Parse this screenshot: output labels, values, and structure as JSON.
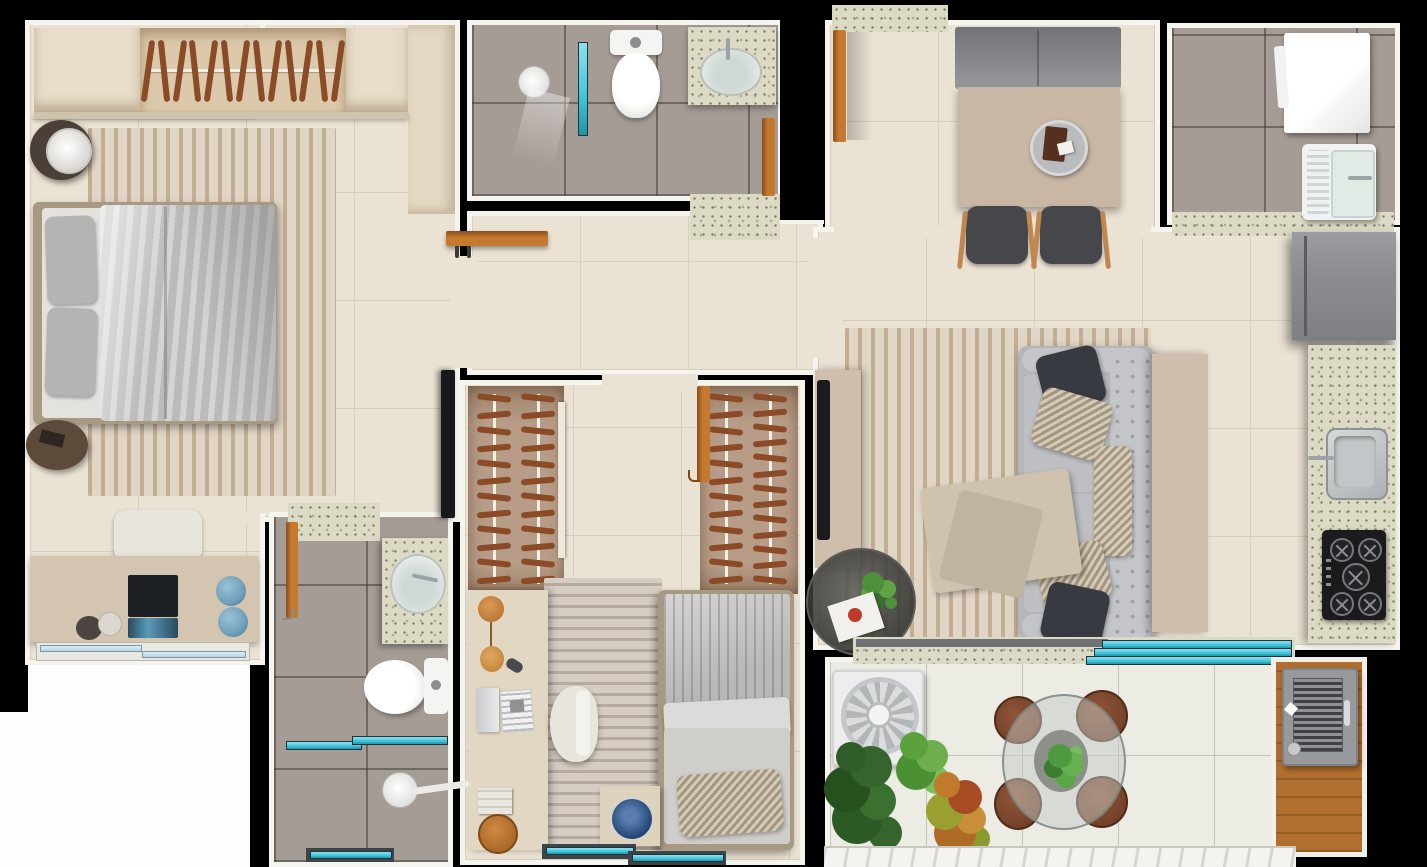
{
  "scene": {
    "description": "Top-down 3D rendered apartment floor plan with two bedrooms, two bathrooms, hallway closets, kitchen, dining, living room, laundry area and balcony with grill",
    "background": "#000000"
  },
  "palette": {
    "bg": "#000000",
    "wallWhite": "#f6f4ef",
    "floorBeige": "#eae2d3",
    "floorLine": "#d7cebc",
    "tileGray": "#a59c96",
    "granite": "#dcd9c4",
    "graniteDot": "#7c7c5e",
    "graniteDot2": "#a9a98c",
    "wood": "#c5792f",
    "woodEdge": "#8a4d1e",
    "hanger": "#8a4b26",
    "closetTan": "#b79d88",
    "glass": "#45c8dc",
    "glassFrame": "#20333c",
    "windowBlue": "#b9d4e4",
    "rugBeige": "#e0d6c7",
    "rugStreak": "#c3ae92",
    "duvet": "#c6c5c3",
    "bedFrame": "#a89a82",
    "pillowGray": "#b5b4b2",
    "sofaGray": "#b4b6b9",
    "sofaLight": "#c3c5c8",
    "pillowDark": "#373b41",
    "benchGray": "#85878b",
    "tableTaupe": "#c9b7a5",
    "consoleBeige": "#cfbeac",
    "chairDark": "#45474b",
    "chairWood": "#c08850",
    "fridgeGray": "#8b8d91",
    "steel": "#c3c6c8",
    "cooktopBlack": "#1b1b1d",
    "grillGray": "#97999d",
    "nicheWood": "#b06f2e",
    "plantGreen": "#4e8f3c",
    "plantDark": "#2f5c28",
    "crotonOrange": "#c07a2c",
    "blueDecor": "#6f9fba",
    "poufBrown": "#5c4a3a",
    "laptopDark": "#1d2126",
    "blanketBeige": "#cfc3b0",
    "chairWhite": "#e8e5dc",
    "deskBeige": "#d3c5b0",
    "exteriorWhite": "#fdfdfd"
  },
  "closets": {
    "bedroom1_top": 13,
    "bedroom2_left": [
      12,
      12
    ],
    "bedroom2_right": [
      12,
      13
    ]
  },
  "counts": {
    "cooktop_burners": 5,
    "balcony_stools": 4,
    "dining_chairs": 2,
    "balcony_sliding_panels": 3,
    "bedroom1_pillows": 2
  }
}
